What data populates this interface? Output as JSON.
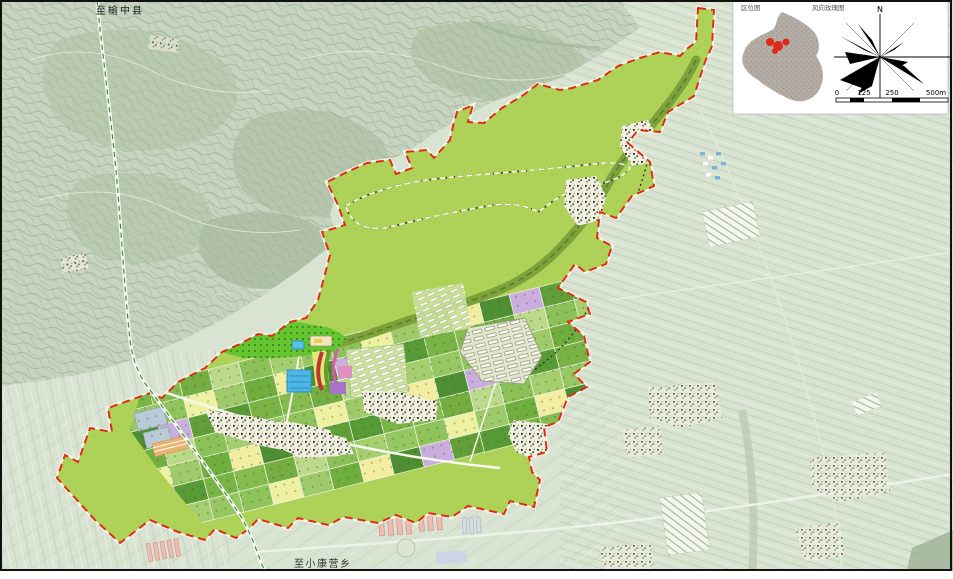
{
  "map": {
    "road_labels": {
      "north": "至榆中县",
      "south": "至小康营乡"
    },
    "inset": {
      "location_title": "区位图",
      "windrose_title": "风向玫瑰图",
      "north_label": "N",
      "scale_ticks": [
        "0",
        "125",
        "250",
        "500m"
      ]
    },
    "colors": {
      "base": "#d8e3d1",
      "mountain": "#c7d5c0",
      "plan_fill": "#aed158",
      "boundary_red": "#e02c12",
      "forest": "#65c52f",
      "stream": "#7da23c",
      "water": "#4cb6e6",
      "highlight_red": "#e02818",
      "parcel_palette": [
        "#7ab446",
        "#8fc35b",
        "#639f39",
        "#a5cf6f",
        "#4f8f33",
        "#bcd98a",
        "#6fae3f",
        "#86bb4f",
        "#eef0a2",
        "#579a36",
        "#97c763",
        "#c9aede",
        "#8cc058",
        "#f2eda0",
        "#74ad42",
        "#9fca6a"
      ]
    }
  }
}
